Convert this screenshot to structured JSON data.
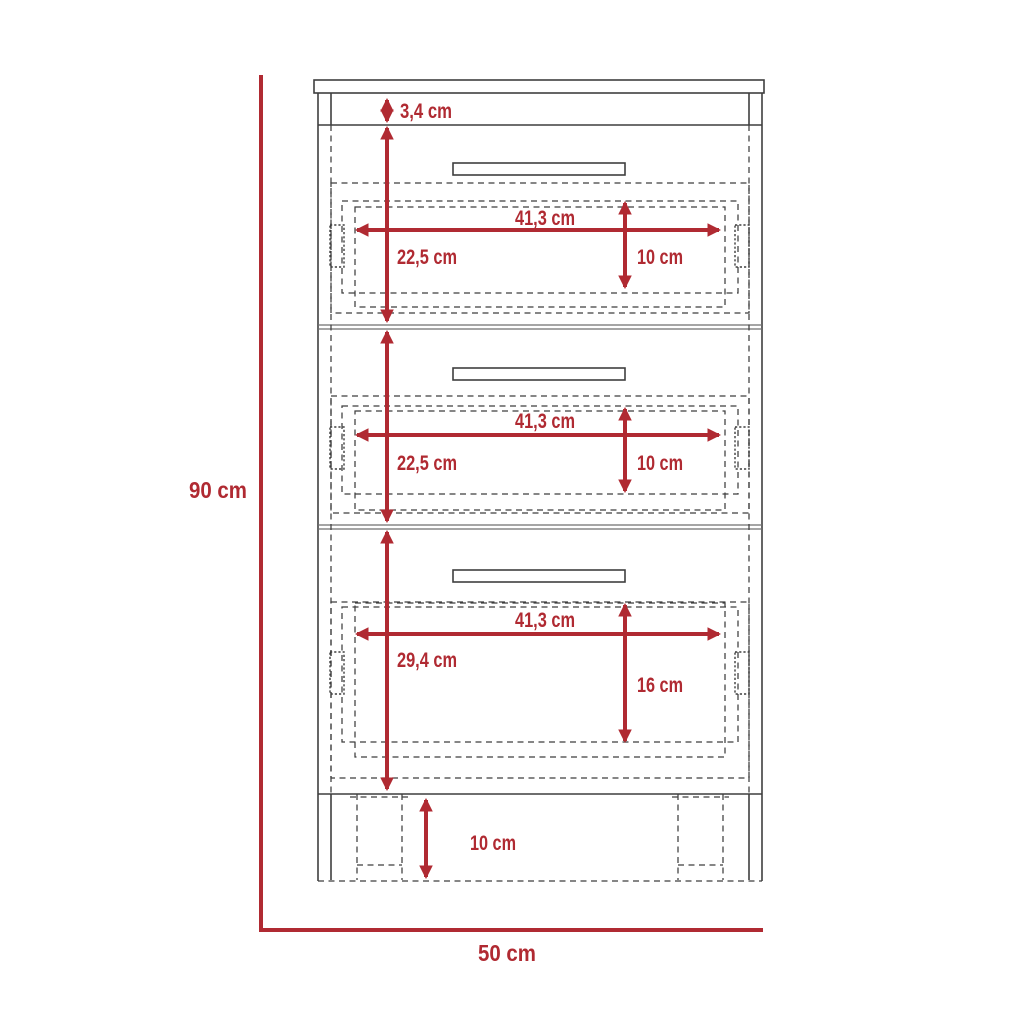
{
  "diagram": {
    "overall": {
      "height": "90 cm",
      "width": "50 cm"
    },
    "top_panel": {
      "thickness": "3,4 cm"
    },
    "drawers": [
      {
        "width": "41,3 cm",
        "section_height": "22,5 cm",
        "box_height": "10 cm"
      },
      {
        "width": "41,3 cm",
        "section_height": "22,5 cm",
        "box_height": "10 cm"
      },
      {
        "width": "41,3 cm",
        "section_height": "29,4 cm",
        "box_height": "16 cm"
      }
    ],
    "base": {
      "leg_height": "10 cm"
    },
    "colors": {
      "dimension": "#b02a32",
      "outline": "#3f3f3f",
      "background": "#ffffff"
    }
  }
}
